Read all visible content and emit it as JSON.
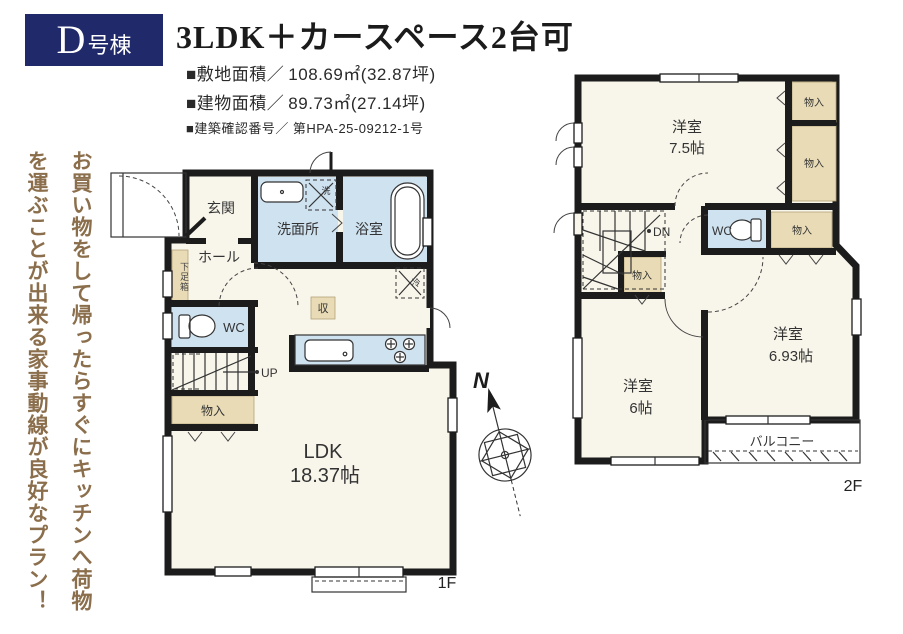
{
  "header": {
    "badge": {
      "letter": "D",
      "suffix": "号棟"
    },
    "title": "3LDK＋カースペース2台可",
    "specs": [
      {
        "label": "■敷地面積／",
        "value": "108.69㎡(32.87坪)"
      },
      {
        "label": "■建物面積／",
        "value": "89.73㎡(27.14坪)"
      },
      {
        "label": "■建築確認番号／",
        "value": "第HPA-25-09212-1号"
      }
    ]
  },
  "tagline": "お買い物をして帰ったらすぐにキッチンへ荷物を運ぶことが出来る家事動線が良好なプラン！",
  "compass": {
    "north_label": "N"
  },
  "floor1": {
    "floor_label": "1F",
    "stairs_label": "UP",
    "rooms": {
      "genkan": "玄関",
      "hall": "ホール",
      "washroom": "洗面所",
      "bathroom": "浴室",
      "wc": "WC",
      "shoe_cabinet": "下足箱",
      "closet": "物入",
      "storage": "収",
      "fridge": "冷",
      "washer": "洗",
      "ldk_name": "LDK",
      "ldk_size": "18.37帖"
    }
  },
  "floor2": {
    "floor_label": "2F",
    "stairs_label": "DN",
    "rooms": {
      "bedroom1_name": "洋室",
      "bedroom1_size": "7.5帖",
      "bedroom2_name": "洋室",
      "bedroom2_size": "6.93帖",
      "bedroom3_name": "洋室",
      "bedroom3_size": "6帖",
      "closet1": "物入",
      "closet2": "物入",
      "closet3": "物入",
      "closet4": "物入",
      "wc": "WC",
      "balcony": "バルコニー"
    }
  },
  "colors": {
    "wall": "#1c1c1c",
    "room_floor": "#f8f5ea",
    "wet_area": "#cfe2f0",
    "closet_fill": "#e8dbb6",
    "badge_navy": "#20296a",
    "tagline_brown": "#8b6e4b"
  }
}
